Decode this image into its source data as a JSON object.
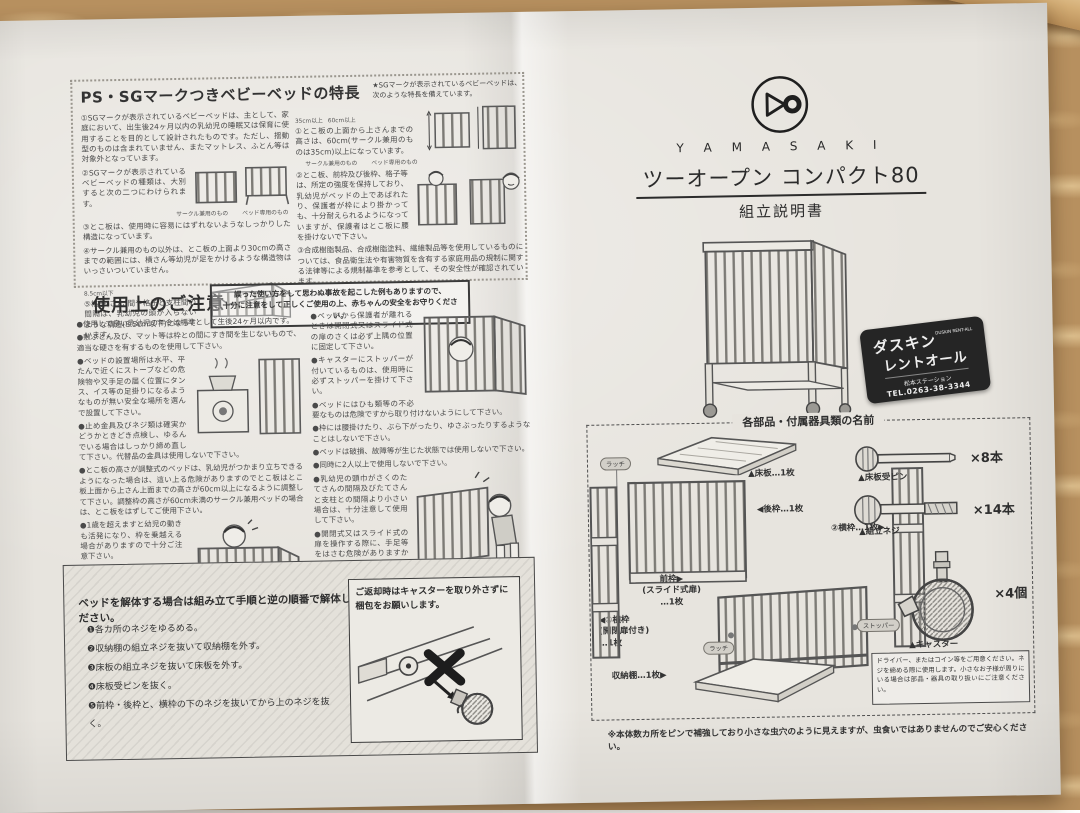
{
  "features": {
    "title": "PS・SGマークつきベビーベッドの特長",
    "note1": "★SGマークが表示されているベビーベッドは、",
    "note2": "次のような特長を備えています。",
    "left": [
      "①SGマークが表示されているベビーベッドは、主として、家庭において、出生後24ヶ月以内の乳幼児の睡眠又は保育に使用することを目的として設計されたものです。ただし、揺動型のものは含まれていません、またマットレス、ふとん等は対象外となっています。",
      "②SGマークが表示されているベビーベッドの種類は、大別すると次の二つにわけられます。",
      "③とこ板は、使用時に容易にはずれないようなしっかりした構造になっています。",
      "④サークル兼用のもの以外は、とこ板の上面より30cmの高さまでの範囲には、横さん等幼児が足をかけるような構造物はいっさいついていません。",
      "⑤格子(さん)間や格子と支柱間の間隔は、乳幼児の頭が入らないような構造(8.5cm以下)になっています。"
    ],
    "right": [
      "①とこ板の上面から上さんまでの高さは、60cm(サークル兼用のものは35cm)以上になっています。",
      "②とこ板、前枠及び後枠、格子等は、所定の強度を保持しており、乳幼児がベッドの上であばれたり、保護者が枠により掛かっても、十分耐えられるようになっていますが、保護者はとこ板に腰を掛けないで下さい。",
      "③合成樹脂製品、合成樹脂塗料、繊維製品等を使用しているものについては、食品衛生法や有害物質を含有する家庭用品の規制に関する法律等による規制基準を参考として、その安全性が確認されています。"
    ],
    "caption_circle": "サークル兼用のもの",
    "caption_bed": "ベッド専用のもの",
    "dim_60": "60cm以上",
    "dim_35": "35cm以上",
    "dim_85": "8.5cm以下"
  },
  "caution": {
    "title": "使用上のご注意",
    "warning1": "誤った使い方をして思わぬ事故を起こした例もありますので、",
    "warning2": "十分に注意をして正しくご使用の上、赤ちゃんの安全をお守りください。",
    "left": [
      "●使用して良い乳幼児の年令は標準として生後24ヶ月以内です。",
      "●敷ぶとん及び、マット等は枠との間にすき間を生じないもので、適当な硬さを有するものを使用して下さい。",
      "●ベッドの設置場所は水平、平たんで近くにストーブなどの危険物や又手足の届く位置にタンス、イス等の足掛りになるようなものが無い安全な場所を選んで設置して下さい。",
      "●止め金具及びネジ類は確実かどうかときどき点検し、ゆるんでいる場合はしっかり締め直して下さい。代替品の金具は使用しないで下さい。",
      "●とこ板の高さが調整式のベッドは、乳幼児がつかまり立ちできるようになった場合は、這い上る危険がありますのでとこ板はとこ板上面から上さん上面までの高さが60cm以上になるように調整して下さい。調整枠の高さが60cm未満のサークル兼用ベッドの場合は、とこ板をはずしてご使用下さい。",
      "●1歳を超えますと幼児の動きも活発になり、枠を乗越える場合がありますので十分ご注意下さい。",
      "●ベッドの内側には、踏み台のかわりになる様な遊具や、折りたたんで高くなったフトン、オムツ、衣料等は置かないようにして下さい。"
    ],
    "right": [
      "●ベッドから保護者が離れるときは開閉式又はスライド式の扉のさくは必ず上隅の位置に固定して下さい。",
      "●キャスターにストッパーが付いているものは、使用時に必ずストッパーを掛けて下さい。",
      "●ベッドにはひも類等の不必要なものは危険ですから取り付けないようにして下さい。",
      "●枠には腰掛けたり、ぶら下がったり、ゆさぶったりするようなことはしないで下さい。",
      "●ベッドは破損、故障等が生じた状態では使用しないで下さい。",
      "●同時に2人以上で使用しないで下さい。",
      "●乳幼児の頭巾がさくのたてさんの間隔及びたてさんと支柱との間隔より小さい場合は、十分注意して使用して下さい。",
      "●開閉式又はスライド式の扉を操作する際に、手足等をはさむ危険がありますから十分注意してご使用頂くと同時に、保護者以外は操作しないで下さい。"
    ]
  },
  "disassembly": {
    "title": "ベッドを解体する場合は組み立て手順と逆の順番で解体してください。",
    "steps": [
      "❶各カ所のネジをゆるめる。",
      "❷収納棚の組立ネジを抜いて収納棚を外す。",
      "❸床板の組立ネジを抜いて床板を外す。",
      "❹床板受ピンを抜く。",
      "❺前枠・後枠と、横枠の下のネジを抜いてから上のネジを抜く。"
    ],
    "return_note1": "ご返却時はキャスターを取り外さずに",
    "return_note2": "梱包をお願いします。"
  },
  "brand": {
    "name": "Y A M A S A K I",
    "product": "ツーオープン コンパクト80",
    "doc": "組立説明書"
  },
  "badge": {
    "line1": "ダスキン",
    "sub1": "DUSKIN",
    "sub2": "RENT-ALL",
    "line2": "レントオール",
    "station": "松本ステーション",
    "tel": "TEL.0263-38-3344"
  },
  "parts": {
    "title": "各部品・付属器具類の名前",
    "floor": "▲床板…1枚",
    "back": "◀後枠…1枚",
    "side2": "②横枠…1枚▶",
    "front1": "前枠▶",
    "front2": "(スライド式扉)",
    "front3": "…1枚",
    "side1a": "◀①横枠",
    "side1b": "(開閉扉付き)",
    "side1c": "…1枚",
    "shelf": "収納棚…1枚▶",
    "latch": "ラッチ",
    "pin_label": "▲床板受ピン",
    "pin_qty": "×8本",
    "screw_label": "▲組立ネジ",
    "screw_qty": "×14本",
    "caster_label": "▲キャスター",
    "caster_qty": "×4個",
    "stopper": "ストッパー",
    "driver_note": "ドライバー、またはコイン等をご用意ください。ネジを締める際に使用します。小さなお子様が周りにいる場合は部品・器具の取り扱いにご注意ください。"
  },
  "footnote": "※本体数カ所をピンで補強しており小さな虫穴のように見えますが、虫食いではありませんのでご安心ください。"
}
